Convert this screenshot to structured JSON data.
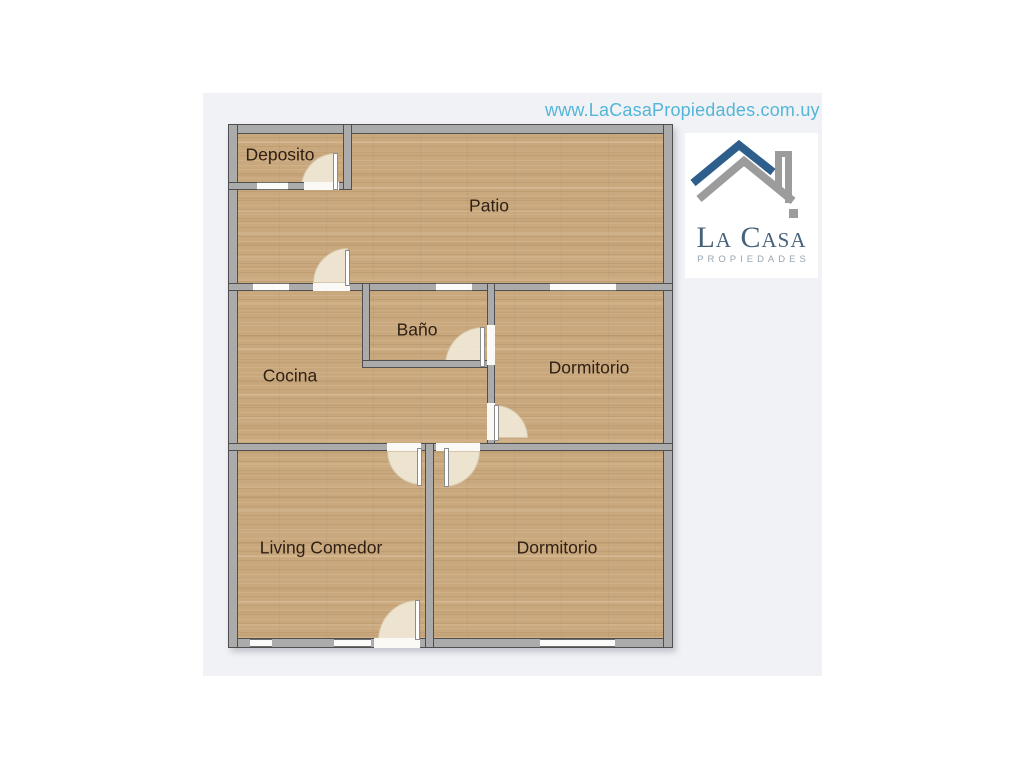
{
  "page": {
    "background_color": "#ffffff",
    "panel_color": "#f1f2f6"
  },
  "header": {
    "website_url": "www.LaCasaPropiedades.com.uy",
    "url_color": "#53b6d8"
  },
  "logo": {
    "name": "La Casa",
    "subtitle": "PROPIEDADES",
    "name_color": "#46627a",
    "subtitle_color": "#98a5af",
    "roof_primary_color": "#2d5e8c",
    "roof_secondary_color": "#9c9c9c"
  },
  "floor_plan": {
    "wall_color": "#ababab",
    "wall_outline_color": "#4f4f4f",
    "floor_color": "#c9a87e",
    "door_arc_color": "#efe7d5",
    "rooms": [
      {
        "id": "deposito",
        "label": "Deposito"
      },
      {
        "id": "patio",
        "label": "Patio"
      },
      {
        "id": "bano",
        "label": "Baño"
      },
      {
        "id": "cocina",
        "label": "Cocina"
      },
      {
        "id": "dormitorio-1",
        "label": "Dormitorio"
      },
      {
        "id": "living-comedor",
        "label": "Living Comedor"
      },
      {
        "id": "dormitorio-2",
        "label": "Dormitorio"
      }
    ]
  }
}
